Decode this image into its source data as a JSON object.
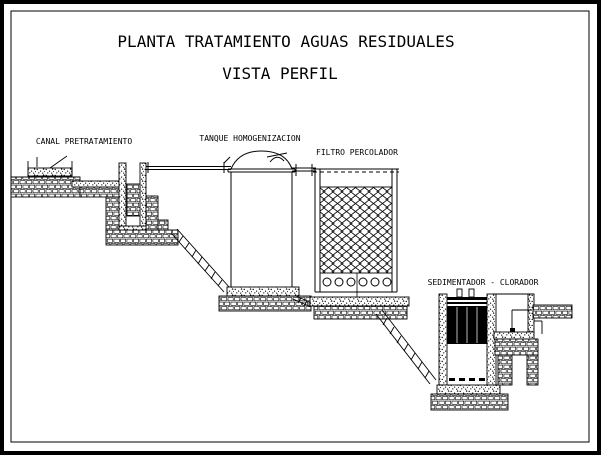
{
  "title": {
    "line1": "PLANTA TRATAMIENTO AGUAS RESIDUALES",
    "line2": "VISTA PERFIL"
  },
  "labels": {
    "canal": "CANAL PRETRATAMIENTO",
    "tanque": "TANQUE HOMOGENIZACION",
    "filtro": "FILTRO PERCOLADOR",
    "sedimentador": "SEDIMENTADOR - CLORADOR"
  },
  "colors": {
    "ink": "#000000",
    "paper": "#ffffff",
    "plate_lines": "#9a9a9a"
  }
}
